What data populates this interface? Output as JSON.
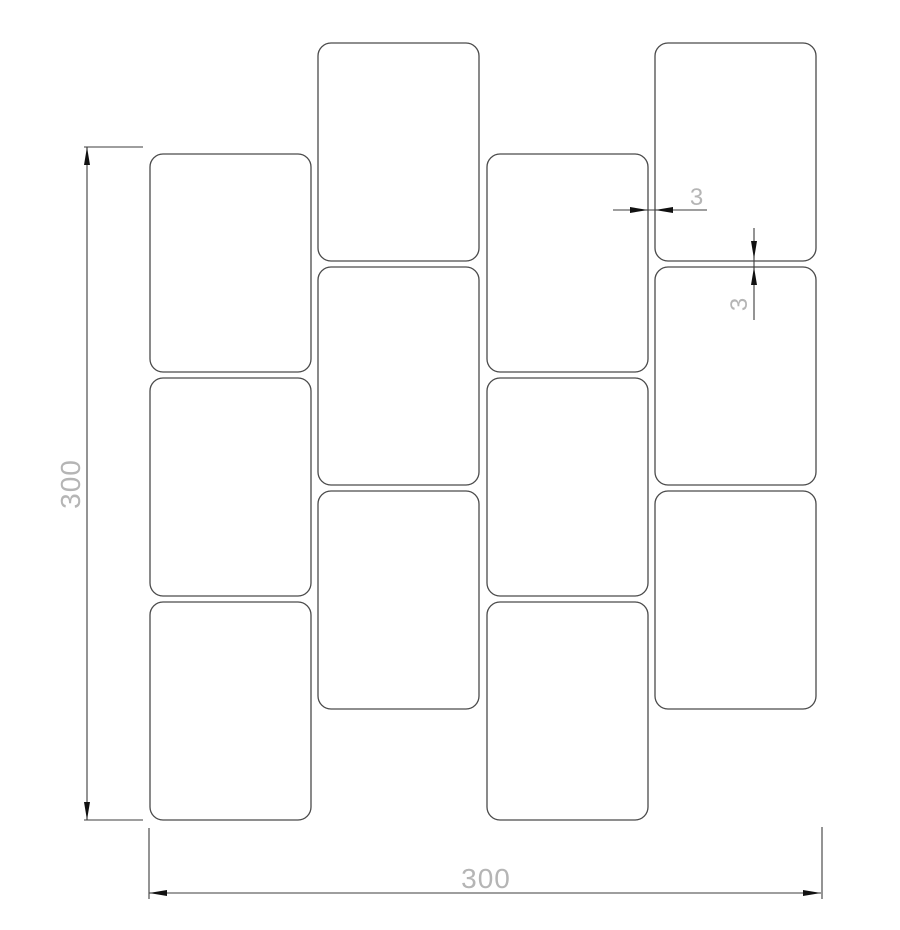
{
  "drawing": {
    "name": "staggered-tile-pattern-drawing",
    "canvas": {
      "width": 900,
      "height": 930,
      "background": "#ffffff"
    },
    "style": {
      "tile_stroke": "#4a4a4a",
      "tile_stroke_width": 1.3,
      "dim_line_color": "#3d3d3d",
      "dim_line_width": 1.1,
      "arrow_color": "#111111",
      "arrow_length": 18,
      "arrow_half_width": 3,
      "label_color": "#b5b5b5",
      "label_font_size_large": 28,
      "label_font_size_small": 24
    },
    "tile": {
      "width": 161,
      "height": 218,
      "corner_radius": 13
    },
    "columns": [
      {
        "id": "column-1",
        "x": 150,
        "tile_tops": [
          154,
          378,
          602
        ]
      },
      {
        "id": "column-2",
        "x": 318,
        "tile_tops": [
          43,
          267,
          491
        ]
      },
      {
        "id": "column-3",
        "x": 487,
        "tile_tops": [
          154,
          378,
          602
        ]
      },
      {
        "id": "column-4",
        "x": 655,
        "tile_tops": [
          43,
          267,
          491
        ]
      }
    ],
    "dimensions": {
      "overall_height": {
        "label": "300",
        "orientation": "vertical",
        "line_x": 87,
        "y1": 147,
        "y2": 820,
        "ticks": [
          {
            "x1": 84,
            "x2": 143,
            "y": 147
          },
          {
            "x1": 84,
            "x2": 143,
            "y": 820
          }
        ],
        "label_x": 80,
        "label_y": 484
      },
      "overall_width": {
        "label": "300",
        "orientation": "horizontal",
        "line_y": 893,
        "x1": 149,
        "x2": 821,
        "ext_lines": [
          {
            "x": 149,
            "y1": 828,
            "y2": 899
          },
          {
            "x": 822,
            "y1": 827,
            "y2": 899
          }
        ],
        "label_x": 486,
        "label_y": 888
      },
      "gap_horizontal": {
        "label": "3",
        "orientation": "horizontal",
        "line_y": 210,
        "tail_x1": 613,
        "gap_x1": 648,
        "gap_x2": 655,
        "tail_x2": 707,
        "label_x": 697,
        "label_y": 205
      },
      "gap_vertical": {
        "label": "3",
        "orientation": "vertical",
        "line_x": 754,
        "tail_y1": 228,
        "gap_y1": 259,
        "gap_y2": 267,
        "tail_y2": 320,
        "label_x": 747,
        "label_y": 304
      }
    }
  }
}
